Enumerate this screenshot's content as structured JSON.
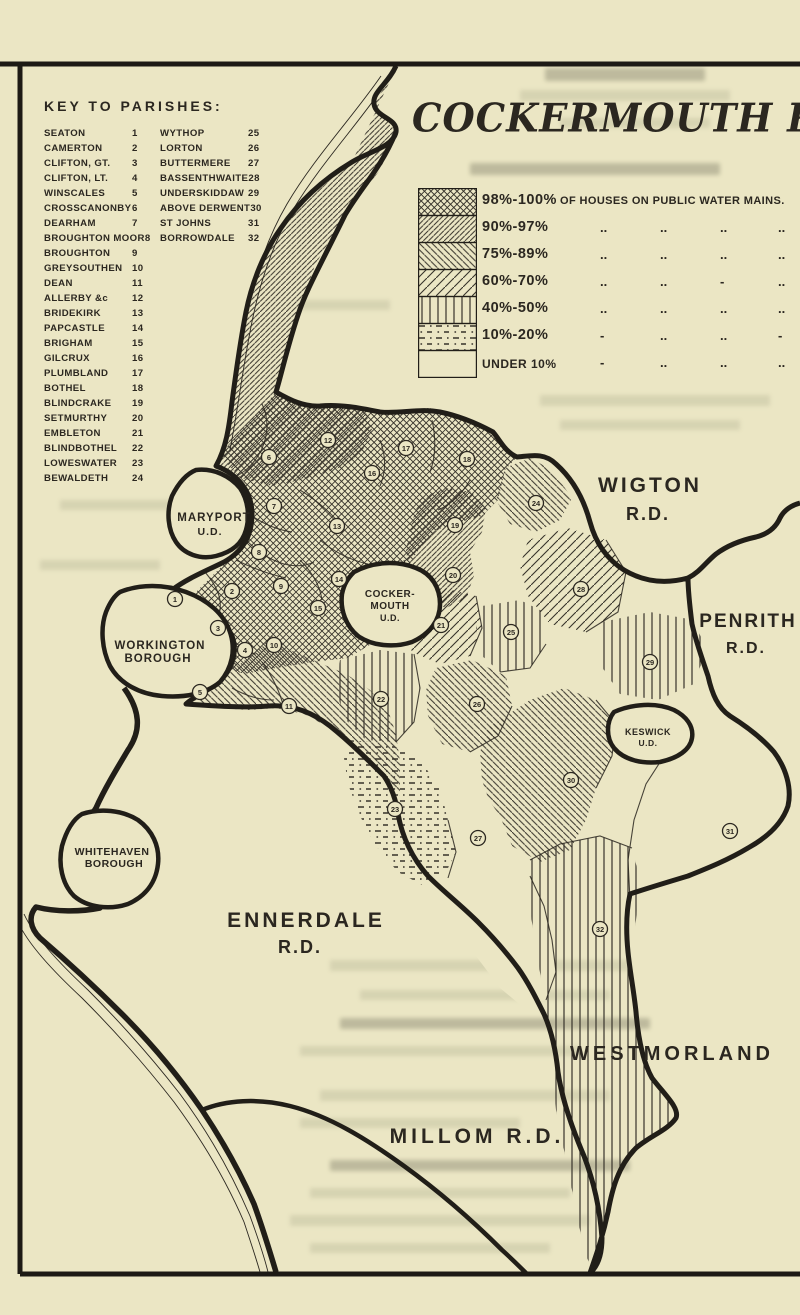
{
  "page": {
    "paper_color": "#ebe6c4",
    "ink_color": "#2b2720",
    "title": "COCKERMOUTH R.D."
  },
  "key": {
    "heading": "KEY TO PARISHES:",
    "left": [
      {
        "name": "SEATON",
        "num": "1"
      },
      {
        "name": "CAMERTON",
        "num": "2"
      },
      {
        "name": "CLIFTON, GT.",
        "num": "3"
      },
      {
        "name": "CLIFTON, LT.",
        "num": "4"
      },
      {
        "name": "WINSCALES",
        "num": "5"
      },
      {
        "name": "CROSSCANONBY",
        "num": "6"
      },
      {
        "name": "DEARHAM",
        "num": "7"
      },
      {
        "name": "BROUGHTON MOOR",
        "num": "8"
      },
      {
        "name": "BROUGHTON",
        "num": "9"
      },
      {
        "name": "GREYSOUTHEN",
        "num": "10"
      },
      {
        "name": "DEAN",
        "num": "11"
      },
      {
        "name": "ALLERBY &c",
        "num": "12"
      },
      {
        "name": "BRIDEKIRK",
        "num": "13"
      },
      {
        "name": "PAPCASTLE",
        "num": "14"
      },
      {
        "name": "BRIGHAM",
        "num": "15"
      },
      {
        "name": "GILCRUX",
        "num": "16"
      },
      {
        "name": "PLUMBLAND",
        "num": "17"
      },
      {
        "name": "BOTHEL",
        "num": "18"
      },
      {
        "name": "BLINDCRAKE",
        "num": "19"
      },
      {
        "name": "SETMURTHY",
        "num": "20"
      },
      {
        "name": "EMBLETON",
        "num": "21"
      },
      {
        "name": "BLINDBOTHEL",
        "num": "22"
      },
      {
        "name": "LOWESWATER",
        "num": "23"
      },
      {
        "name": "BEWALDETH",
        "num": "24"
      }
    ],
    "right": [
      {
        "name": "WYTHOP",
        "num": "25"
      },
      {
        "name": "LORTON",
        "num": "26"
      },
      {
        "name": "BUTTERMERE",
        "num": "27"
      },
      {
        "name": "BASSENTHWAITE",
        "num": "28"
      },
      {
        "name": "UNDERSKIDDAW",
        "num": "29"
      },
      {
        "name": "ABOVE DERWENT",
        "num": "30"
      },
      {
        "name": "ST JOHNS",
        "num": "31"
      },
      {
        "name": "BORROWDALE",
        "num": "32"
      }
    ]
  },
  "legend": {
    "rows": [
      {
        "range": "98%-100%",
        "pattern": "xhatch",
        "note": "OF HOUSES ON  PUBLIC WATER MAINS.",
        "dittos": []
      },
      {
        "range": "90%-97%",
        "pattern": "diagA",
        "note": "",
        "dittos": [
          "..",
          "..",
          "..",
          ".."
        ]
      },
      {
        "range": "75%-89%",
        "pattern": "diagB",
        "note": "",
        "dittos": [
          "..",
          "..",
          "..",
          ".."
        ]
      },
      {
        "range": "60%-70%",
        "pattern": "diagC",
        "note": "",
        "dittos": [
          "..",
          "..",
          "-",
          ".."
        ]
      },
      {
        "range": "40%-50%",
        "pattern": "vert",
        "note": "",
        "dittos": [
          "..",
          "..",
          "..",
          ".."
        ]
      },
      {
        "range": "10%-20%",
        "pattern": "dots",
        "note": "",
        "dittos": [
          "-",
          "..",
          "..",
          "-"
        ]
      },
      {
        "range": "UNDER 10%",
        "pattern": "blank",
        "note": "",
        "dittos": [
          "-",
          "..",
          "..",
          ".."
        ]
      }
    ]
  },
  "map": {
    "labels": [
      {
        "text": "WIGTON",
        "x": 650,
        "y": 492,
        "size": 21,
        "ls": 3
      },
      {
        "text": "R.D.",
        "x": 648,
        "y": 520,
        "size": 18,
        "ls": 2
      },
      {
        "text": "PENRITH",
        "x": 748,
        "y": 627,
        "size": 19,
        "ls": 2
      },
      {
        "text": "R.D.",
        "x": 746,
        "y": 653,
        "size": 16,
        "ls": 2
      },
      {
        "text": "WESTMORLAND",
        "x": 672,
        "y": 1060,
        "size": 20,
        "ls": 4
      },
      {
        "text": "ENNERDALE",
        "x": 306,
        "y": 927,
        "size": 21,
        "ls": 3
      },
      {
        "text": "R.D.",
        "x": 300,
        "y": 953,
        "size": 18,
        "ls": 2
      },
      {
        "text": "MILLOM  R.D.",
        "x": 477,
        "y": 1143,
        "size": 21,
        "ls": 4
      },
      {
        "text": "MARYPORT",
        "x": 214,
        "y": 521,
        "size": 11.5,
        "ls": 1
      },
      {
        "text": "U.D.",
        "x": 210,
        "y": 535,
        "size": 10.5,
        "ls": 1
      },
      {
        "text": "WORKINGTON",
        "x": 160,
        "y": 649,
        "size": 11.5,
        "ls": 1
      },
      {
        "text": "BOROUGH",
        "x": 158,
        "y": 662,
        "size": 11.5,
        "ls": 1
      },
      {
        "text": "WHITEHAVEN",
        "x": 112,
        "y": 855,
        "size": 10.5,
        "ls": 0.5
      },
      {
        "text": "BOROUGH",
        "x": 114,
        "y": 867,
        "size": 10.5,
        "ls": 0.5
      },
      {
        "text": "COCKER-",
        "x": 390,
        "y": 597,
        "size": 10,
        "ls": 0.5
      },
      {
        "text": "MOUTH",
        "x": 390,
        "y": 609,
        "size": 10,
        "ls": 0.5
      },
      {
        "text": "U.D.",
        "x": 390,
        "y": 621,
        "size": 9,
        "ls": 0.5
      },
      {
        "text": "KESWICK",
        "x": 648,
        "y": 735,
        "size": 9,
        "ls": 0.5
      },
      {
        "text": "U.D.",
        "x": 648,
        "y": 746,
        "size": 8.5,
        "ls": 0.5
      }
    ],
    "markers": [
      {
        "n": "1",
        "x": 175,
        "y": 599
      },
      {
        "n": "2",
        "x": 232,
        "y": 591
      },
      {
        "n": "3",
        "x": 218,
        "y": 628
      },
      {
        "n": "4",
        "x": 245,
        "y": 650
      },
      {
        "n": "5",
        "x": 200,
        "y": 692
      },
      {
        "n": "6",
        "x": 269,
        "y": 457
      },
      {
        "n": "7",
        "x": 274,
        "y": 506
      },
      {
        "n": "8",
        "x": 259,
        "y": 552
      },
      {
        "n": "9",
        "x": 281,
        "y": 586
      },
      {
        "n": "10",
        "x": 274,
        "y": 645
      },
      {
        "n": "11",
        "x": 289,
        "y": 706
      },
      {
        "n": "12",
        "x": 328,
        "y": 440
      },
      {
        "n": "13",
        "x": 337,
        "y": 526
      },
      {
        "n": "14",
        "x": 339,
        "y": 579
      },
      {
        "n": "15",
        "x": 318,
        "y": 608
      },
      {
        "n": "16",
        "x": 372,
        "y": 473
      },
      {
        "n": "17",
        "x": 406,
        "y": 448
      },
      {
        "n": "18",
        "x": 467,
        "y": 459
      },
      {
        "n": "19",
        "x": 455,
        "y": 525
      },
      {
        "n": "20",
        "x": 453,
        "y": 575
      },
      {
        "n": "21",
        "x": 441,
        "y": 625
      },
      {
        "n": "22",
        "x": 381,
        "y": 699
      },
      {
        "n": "23",
        "x": 395,
        "y": 809
      },
      {
        "n": "24",
        "x": 536,
        "y": 503
      },
      {
        "n": "25",
        "x": 511,
        "y": 632
      },
      {
        "n": "26",
        "x": 477,
        "y": 704
      },
      {
        "n": "27",
        "x": 478,
        "y": 838
      },
      {
        "n": "28",
        "x": 581,
        "y": 589
      },
      {
        "n": "29",
        "x": 650,
        "y": 662
      },
      {
        "n": "30",
        "x": 571,
        "y": 780
      },
      {
        "n": "31",
        "x": 730,
        "y": 831
      },
      {
        "n": "32",
        "x": 600,
        "y": 929
      }
    ],
    "zone_patterns": {
      "coastal-strip-6-12": "diagA",
      "west-core-1-4-7-9-13-18": "xhatch",
      "south-band-5-10-11": "diagB",
      "blindcrake-setmurthy-19-20": "diagA",
      "embleton-21": "diagC",
      "blindbothel-22": "vert",
      "loweswater-23": "dots",
      "bewaldeth-24": "diagB",
      "wythop-25": "vert",
      "lorton-26": "diagB",
      "buttermere-27": "blank",
      "bassenthwaite-28": "diagC",
      "underskiddaw-29": "vert",
      "above-derwent-30": "diagB",
      "st-johns-31": "blank",
      "borrowdale-32": "vert"
    }
  }
}
